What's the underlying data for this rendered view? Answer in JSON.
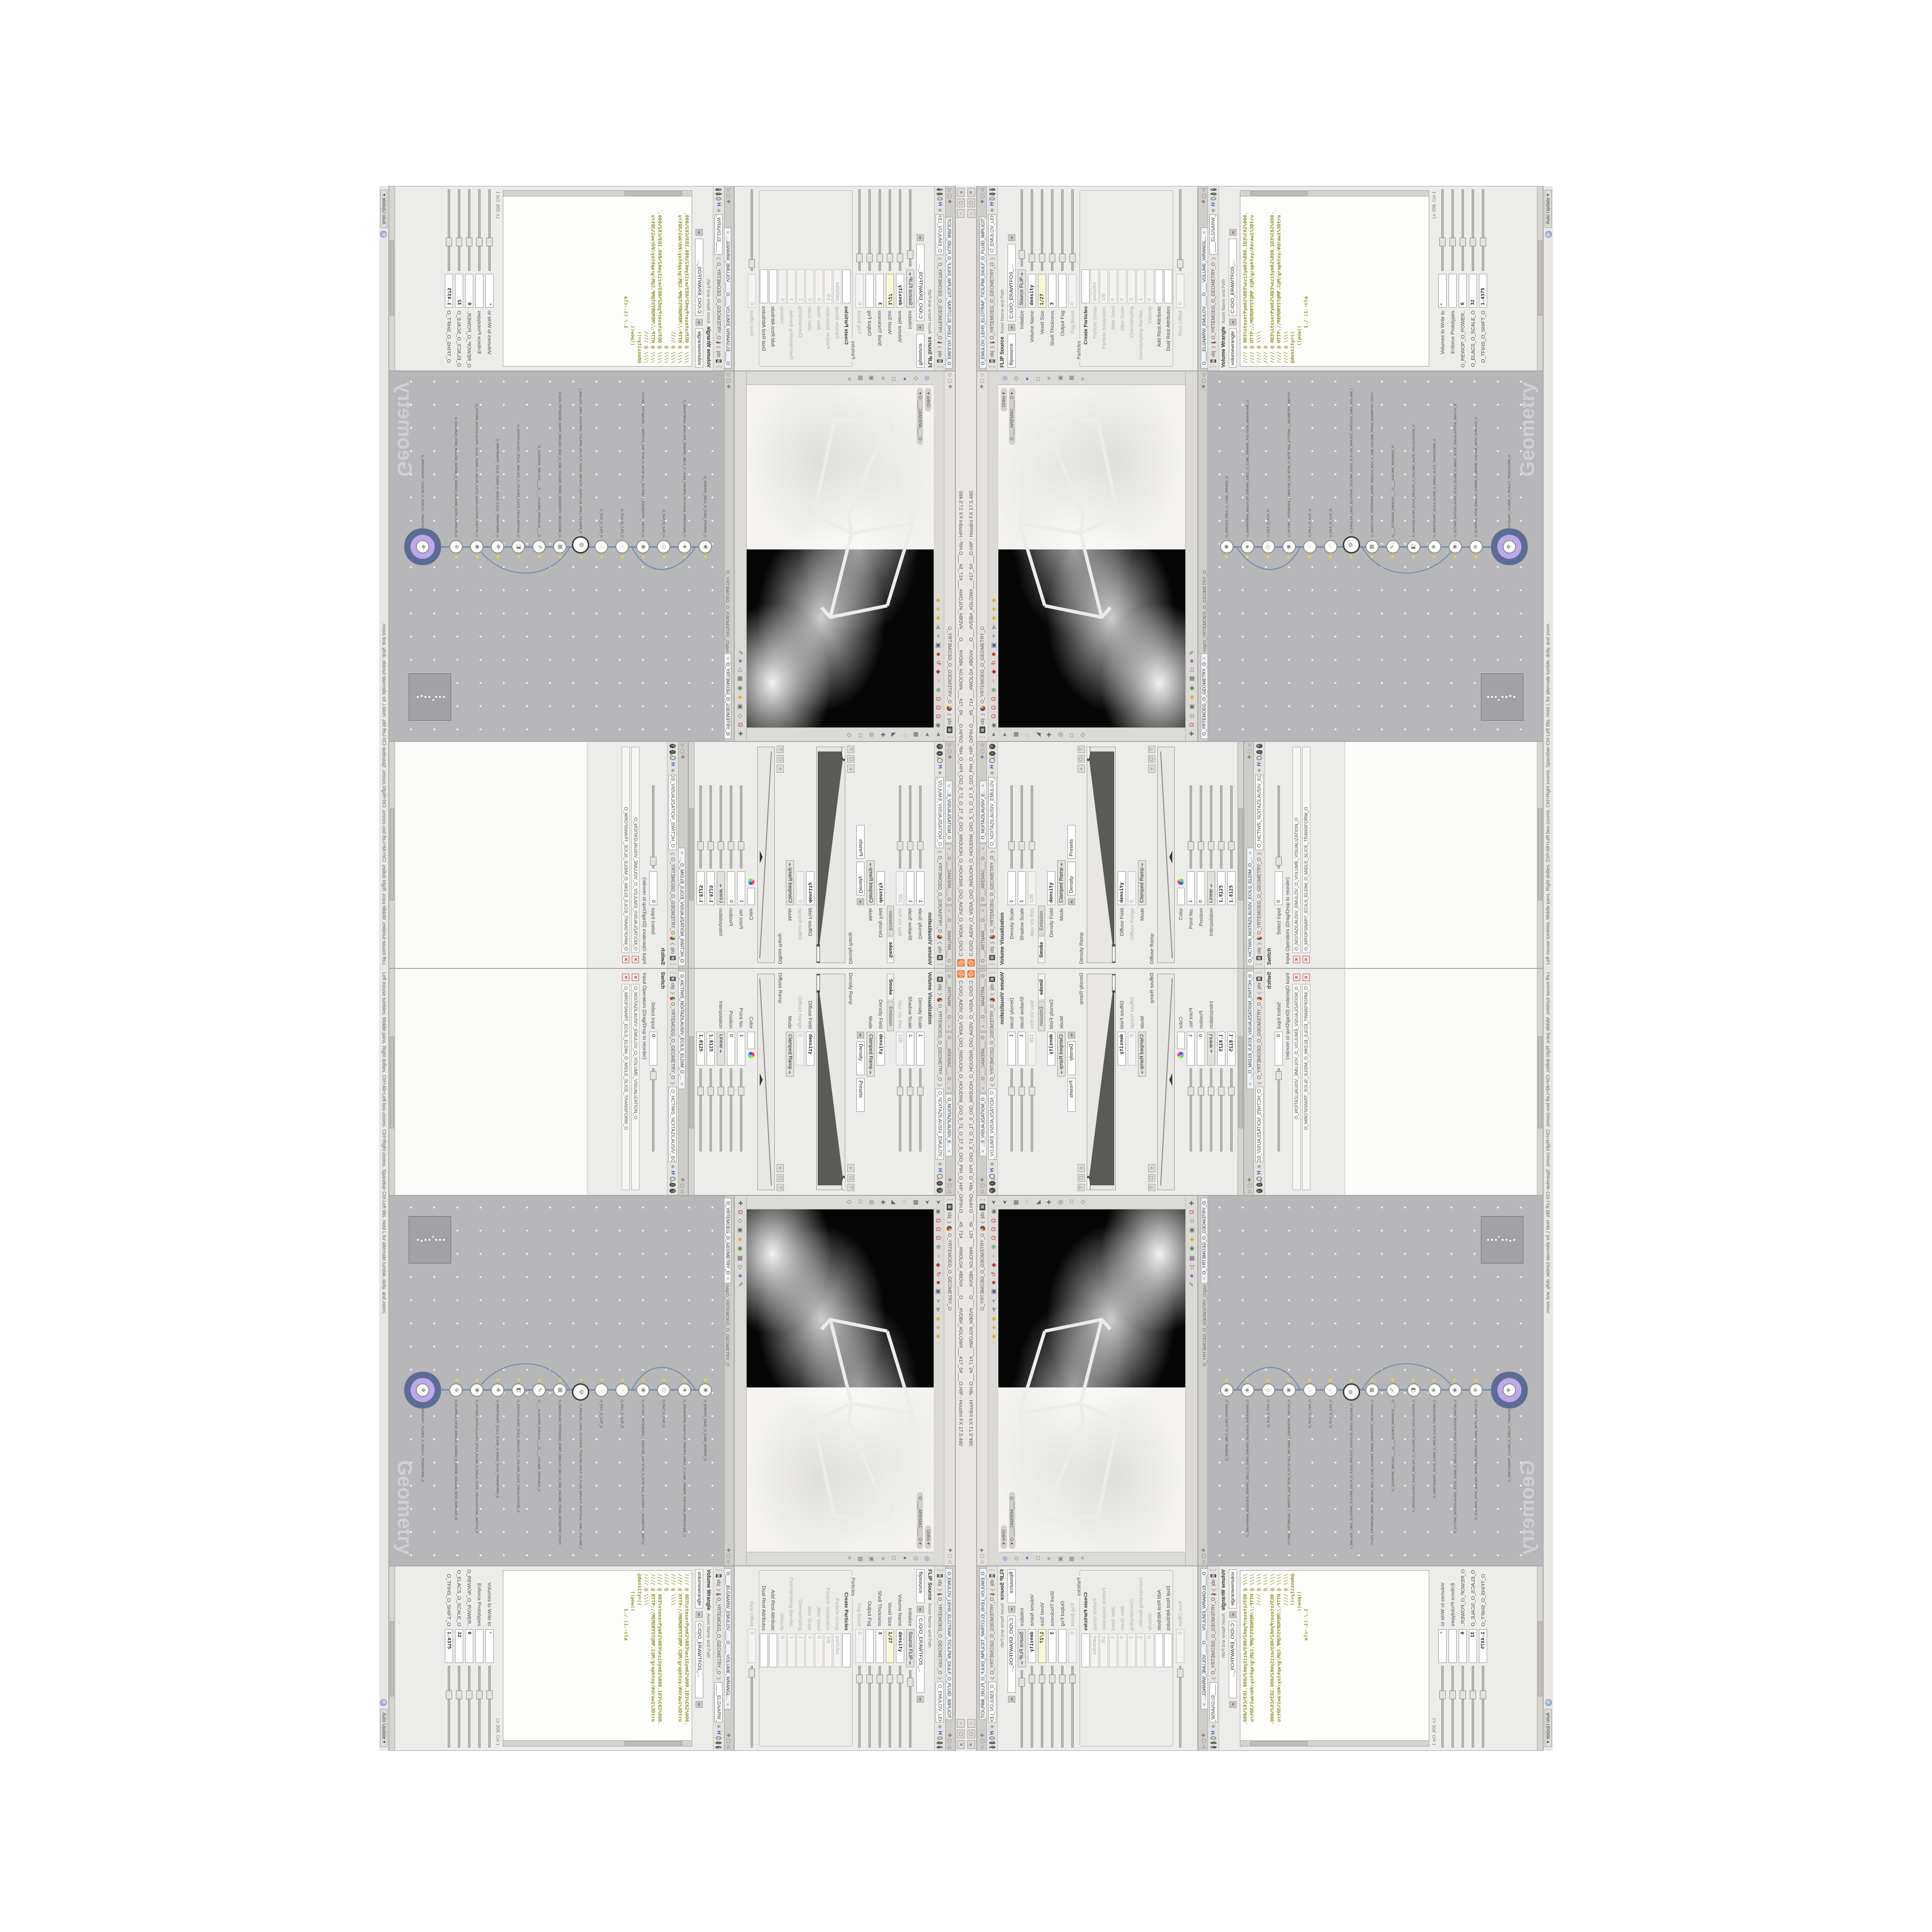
{
  "window": {
    "title": "C:/O/O_AIDIV_O_VIDIA_O/O_INIDUOH_O_HOUDINI_O/O_5_71_O_17_5_O/O_PIH_O_HIP_O/PIH.O___#5_71#___#WOLG#_#BDV#___O___#VDB#_#GLOW#___#17_5#___O.HIP - Houdini FX 17.5.460",
    "minimize": "–",
    "restore": "▢",
    "close": "✕"
  },
  "statusbar": {
    "help": "Left mouse tumbles. Middle pans. Right dollies. Ctrl+Alt+Left box-zooms. Ctrl+Right zooms. Spacebar-Ctrl-Left tilts. Hold L for alternate tumble, dolly, and zoom.",
    "auto_update": "Auto Update"
  },
  "breadcrumb": {
    "root": "obj",
    "geo": "O_YRTEMOEG_O_GEOMETRY_O"
  },
  "left_group": {
    "tabs": [
      {
        "label": "O ___ARTNAM___ O...",
        "cls": ""
      },
      {
        "label": "O ___AREMAC___ O...",
        "cls": ""
      },
      {
        "label": "O_NOITAZILAUSIV_E...",
        "cls": "active"
      }
    ]
  },
  "volviz": {
    "title": "Volume Visualization",
    "node_field": "O_NOITAZILAUSIV_EMULOV_O_VO",
    "rows_a": [
      {
        "label": "Density Scale",
        "value": "1",
        "cls": "slider"
      },
      {
        "label": "Shadow Scale",
        "value": "1",
        "cls": "slider"
      },
      {
        "label": "Max Vis Res",
        "value": "128",
        "cls": "gray"
      }
    ],
    "tab_smoke": "Smoke",
    "tab_emission": "Emission",
    "rows_b": [
      {
        "label": "Density Field",
        "value": "density",
        "cls": "bold"
      },
      {
        "label": "Mode",
        "value": "Clamped Ramp",
        "cls": "menu"
      }
    ],
    "mode_target": "Density",
    "presets": "Presets",
    "density_ramp_label": "Density Ramp",
    "rows_c": [
      {
        "label": "Diffuse Field",
        "value": "density",
        "cls": "bold"
      },
      {
        "label": "Diffuse Range",
        "value": "0",
        "cls": "gray slider"
      },
      {
        "label": "Mode",
        "value": "Clamped Ramp",
        "cls": "menu"
      }
    ],
    "mode2_target": "Diffuse",
    "diffuse_ramp_label": "Diffuse Ramp",
    "rows_d": [
      {
        "label": "Point No.",
        "value": "1",
        "cls": ""
      },
      {
        "label": "Position",
        "value": "0",
        "cls": "slider"
      },
      {
        "label": "Interpolation",
        "value": "Linear",
        "cls": "menu"
      },
      {
        "label": "",
        "value": "1.8125",
        "cls": "slider bold"
      },
      {
        "label": "",
        "value": "1.8125",
        "cls": "slider bold"
      },
      {
        "label": "",
        "value": "1.8125",
        "cls": "slider bold"
      }
    ],
    "color_label": "Color"
  },
  "switchp": {
    "tab": "O_HCTIWS_NOITAZILAUSIV_ECILS_ELDIM_O_...",
    "title": "Switch",
    "node_field": "O_HCTIWS_NOITAZILAUSIV_ECILS_ELDIM_O_",
    "rows": [
      {
        "label": "Select Input",
        "value": "0",
        "cls": "slider"
      }
    ],
    "group": "Input Operators (Drag/Drop to reorder)",
    "ops": [
      {
        "name": "O_NOITAZILAUSIV_EMULOV_O_VOLUME_VISUALIZATION_O"
      },
      {
        "name": "O_MROFSNART_ECILS_ELDIM_O_MIDLE_SLICE_TRANSFORM_O"
      }
    ]
  },
  "viewport": {
    "pills": [
      {
        "label": "Ortho ▾"
      },
      {
        "label": "O ___AREMAC___ O ▾"
      }
    ],
    "top_icons": [
      {
        "name": "select-arrow",
        "glyph": "➤",
        "color": "#666"
      },
      {
        "name": "handle",
        "glyph": "◉",
        "color": "#666"
      },
      {
        "name": "snap-magnet-1",
        "glyph": "Ω",
        "color": "#b5372c"
      },
      {
        "name": "snap-magnet-2",
        "glyph": "Ω",
        "color": "#b5372c"
      },
      {
        "name": "snap-magnet-3",
        "glyph": "Ω",
        "color": "#b5372c"
      },
      {
        "name": "axis-gnomon",
        "glyph": "⊕",
        "color": "#4a8f3c"
      },
      {
        "name": "cut-tool",
        "glyph": "✕",
        "color": "#caa"
      },
      {
        "name": "translate-tool",
        "glyph": "◆",
        "color": "#b5372c"
      },
      {
        "name": "rotate-tool",
        "glyph": "↻",
        "color": "#b5372c"
      },
      {
        "name": "scale-tool",
        "glyph": "■",
        "color": "#b5372c"
      },
      {
        "name": "view-3d",
        "glyph": "▣",
        "color": "#557"
      },
      {
        "name": "pointer",
        "glyph": "➤",
        "color": "#999"
      },
      {
        "name": "play",
        "glyph": "▶",
        "color": "#999"
      },
      {
        "name": "shade-box-1",
        "glyph": "◆",
        "color": "#d9b43a"
      },
      {
        "name": "shade-box-2",
        "glyph": "◈",
        "color": "#d9b43a"
      },
      {
        "name": "shade-box-3",
        "glyph": "◆",
        "color": "#d9b43a"
      }
    ],
    "left_icons": [
      {
        "name": "select-mode",
        "glyph": "➤",
        "color": "#666"
      },
      {
        "name": "box-pick",
        "glyph": "▦",
        "color": "#666"
      },
      {
        "name": "lasso-pick",
        "glyph": "◌",
        "color": "#666"
      },
      {
        "name": "brush",
        "glyph": "◢",
        "color": "#666"
      },
      {
        "name": "pan-hand",
        "glyph": "✚",
        "color": "#666"
      },
      {
        "name": "dolly-zoom",
        "glyph": "◎",
        "color": "#666"
      },
      {
        "name": "frame-all",
        "glyph": "□",
        "color": "#666"
      },
      {
        "name": "key-tool",
        "glyph": "◇",
        "color": "#666"
      }
    ],
    "right_icons": [
      {
        "name": "ripple-display",
        "glyph": "◎",
        "color": "#4a72c4"
      },
      {
        "name": "wire-cube",
        "glyph": "◇",
        "color": "#666"
      },
      {
        "name": "shaded-sphere",
        "glyph": "●",
        "color": "#5577cc"
      },
      {
        "name": "flat-square",
        "glyph": "□",
        "color": "#666"
      },
      {
        "name": "light-toggle",
        "glyph": "✳",
        "color": "#888"
      },
      {
        "name": "camera-toggle",
        "glyph": "▣",
        "color": "#888"
      },
      {
        "name": "grid-toggle",
        "glyph": "▦",
        "color": "#888"
      },
      {
        "name": "info-display",
        "glyph": "≡",
        "color": "#888"
      }
    ],
    "bottom_icons": [
      {
        "name": "persp-hand",
        "glyph": "✚",
        "color": "#666"
      },
      {
        "name": "view-magnet",
        "glyph": "Ω",
        "color": "#b5372c"
      },
      {
        "name": "view-key",
        "glyph": "◇",
        "color": "#666"
      },
      {
        "name": "snapshot",
        "glyph": "▣",
        "color": "#666"
      },
      {
        "name": "color-correct",
        "glyph": "◆",
        "color": "#d9b43a"
      },
      {
        "name": "exposure",
        "glyph": "◉",
        "color": "#4a8f3c"
      },
      {
        "name": "lut",
        "glyph": "▦",
        "color": "#666"
      },
      {
        "name": "res-fraction",
        "glyph": "▷",
        "color": "#666"
      },
      {
        "name": "sim-cache",
        "glyph": "■",
        "color": "#87b"
      },
      {
        "name": "grease-pencil",
        "glyph": "✎",
        "color": "#666"
      }
    ]
  },
  "network": {
    "tab": "O_YRTEMOEG_O_GEOMETRY_O",
    "path": "/obj/O_YRTEMOEG_O_GEOMETRY_O",
    "watermark": "Geometry",
    "nodes": [
      {
        "glyph": "◉",
        "name": "O_EREHPS_EBUC_O_CUBE_SPHERE_O",
        "cls": ""
      },
      {
        "glyph": "◈",
        "name": "O_EMARFERIW_NOGYLOP_EREHPS_EBUC_O_CUBE_SPHERE_POLYGON_WIREFRAME_O",
        "cls": ""
      },
      {
        "glyph": "◇",
        "name": "O_PILF_O_FLIP_O",
        "cls": ""
      },
      {
        "glyph": "◉",
        "name": "O_HCTIWS_YRTEMOEG_LANRETXE_LANRETNI_O_INTERNAL_EXTERNAL_GEOMETRY_SWITCH_O",
        "cls": ""
      },
      {
        "glyph": "◌",
        "name": "O_PILC_O_CLIP_O",
        "cls": ""
      },
      {
        "glyph": "◌",
        "name": "O_PILC_O_CLIP_O",
        "cls": ""
      },
      {
        "glyph": "◍",
        "name": "O_EMULOV_LEHS_ELCITRAP_TICILPMI_DIULF_O_FLUID_IMPLICIT_PARTICLE_SHEL_VOLUME_O",
        "cls": "big"
      },
      {
        "glyph": "▦",
        "name": "O_SNOGYLOP_YRTEMOEG_MORF_EMULOV_BDV_O_VDB_VOLUME_FROM_GEOMETRY_POLYGONS_O",
        "cls": ""
      },
      {
        "glyph": "✎",
        "name": "O____ELGNARW_EMULOV____O____VOLUME_WRANGLE_O",
        "cls": ""
      },
      {
        "glyph": "◧",
        "name": "O_NOITAZILAUSIV_ECILS_EMULOV_O_VOLUME_SLICE_VISUALIZATION_O",
        "cls": ""
      },
      {
        "glyph": "✥",
        "name": "O_MROFSNART_ECILS_ELDIM_O_MIDLE_SLICE_TRANSFORM_O",
        "cls": ""
      },
      {
        "glyph": "◉",
        "name": "O_HCTIWS_NOITAZILAUSIV_ECILS_ELDIM_O_MIDLE_SLICE_VISUALIZATION_SWITCH_O",
        "cls": ""
      },
      {
        "glyph": "⊕",
        "name": "O_ECAFRUS_HTIW_EMULOV_EGREM_O_MERGE_VOLUME_WITH_SURFACE_O",
        "cls": ""
      },
      {
        "glyph": "✥",
        "name": "O_MROFSNART_TLUSER_O_RESULT_TRANSFORM_O",
        "cls": "selected"
      }
    ]
  },
  "flip": {
    "tab": "O_EMULOV_LEHS_ELCITRAP_TICILPMI_DIULF_O_FLUID_IMPLICIT_PARTICLE...",
    "title": "FLIP Source",
    "node_field": "O_EMULOV_LEHS_ELCITRAP_TICILPMI_DI",
    "asset_label": "Asset Name and Path",
    "asset_name": "flipsource",
    "asset_path": "C:/O/O_ERAWTFOS_...",
    "rows_a": [
      {
        "label": "Initialize",
        "value": "Source FLIP",
        "cls": "menu"
      },
      {
        "label": "Volume Name",
        "value": "density",
        "cls": "bold"
      },
      {
        "label": "Voxel Size",
        "value": "1/27",
        "cls": "yellow slider bold"
      },
      {
        "label": "Shell Thickness",
        "value": "3",
        "cls": "slider bold"
      },
      {
        "label": "Output Fog",
        "value": "",
        "cls": "chk"
      },
      {
        "label": "Fog Boost",
        "value": "0",
        "cls": "gray slider"
      }
    ],
    "particles_label": "Particles",
    "rows_b": [
      {
        "label": "Create Particles",
        "value": "",
        "cls": "chk bolded"
      },
      {
        "label": "Particle Group",
        "value": "particles",
        "cls": "gray"
      },
      {
        "label": "Particle Separation",
        "value": "1/9",
        "cls": "gray slider"
      },
      {
        "label": "Jitter Seed",
        "value": "0",
        "cls": "gray"
      },
      {
        "label": "Jitter Scale",
        "value": "0",
        "cls": "gray slider"
      },
      {
        "label": "Oversampling",
        "value": "2",
        "cls": "gray slider"
      },
      {
        "label": "Oversampling Bandwi...",
        "value": "1",
        "cls": "gray"
      },
      {
        "label": "Velocity",
        "value": "0",
        "cls": "gray"
      },
      {
        "label": "Add Rest Attribute",
        "value": "",
        "cls": "chk"
      },
      {
        "label": "Dual Rest Attributes",
        "value": "",
        "cls": "chk"
      }
    ],
    "rows_c": [
      {
        "label": "Rest Offset",
        "value": "0",
        "cls": "gray slider"
      }
    ]
  },
  "wrangle": {
    "tab": "O____ELGNARW_EMULOV____O____VOLUME_WRANGL...",
    "title": "Volume Wrangle",
    "node_field": "____ELGNARW_EMULOV____O____VOl",
    "asset_label": "Asset Name and Path",
    "asset_name": "volumewrangle",
    "asset_path": "C:/O/O_ERAWTFOS_...",
    "code_lines": [
      {
        "t": "//// @ 0D3%steserPym62%0D3%eziSym62%000.1D3%C62%000.",
        "c": ""
      },
      {
        "t": "//// @ HTTP://MEMORYST@MP.C@M/graphtoy/#draw1%3Dtru",
        "c": ""
      },
      {
        "t": "//// @ \\\\\\\\",
        "c": ""
      },
      {
        "t": "//// @",
        "c": ""
      },
      {
        "t": "//// @ 0D3%steserPym62%0D3%eziSym62%000.1D3%C62%000.",
        "c": ""
      },
      {
        "t": "//// @ HTTP://MEMORYST@MP.C@M/graphtoy/#draw1%3Dtru",
        "c": ""
      },
      {
        "t": "//// @ \\\\\\\\",
        "c": ""
      },
      {
        "t": "",
        "c": ""
      },
      {
        "t": "@density=((",
        "c": "dark"
      },
      {
        "t": "      ((pow((",
        "c": "dark"
      },
      {
        "t": "            1./ (1.-cla",
        "c": "teal"
      }
    ],
    "lncol": "Ln 209, Col 1",
    "rows": [
      {
        "label": "Volumes to Write to",
        "value": "*",
        "cls": ""
      },
      {
        "label": "Enforce Prototypes",
        "value": "",
        "cls": "chk"
      },
      {
        "label": "O_REWOP_O_POWER...",
        "value": "6",
        "cls": "slider bold"
      },
      {
        "label": "O_ELACS_O_SCALE_O",
        "value": "32",
        "cls": "slider bold"
      },
      {
        "label": "O_TFIHS_O_SHIFT_O",
        "value": "1.4375",
        "cls": "slider bold"
      }
    ]
  },
  "colors": {
    "accent_orange": "#f26b21",
    "field_yellow": "#fbf8d8",
    "code_olive": "#8f8f23",
    "code_teal": "#2a9d9d",
    "wire_blue": "#5b7fae",
    "node_select_purple": "#bda8ec",
    "node_select_ring": "#5d6c94",
    "network_bg": "#b7b6b9",
    "viewport_black": "#050505",
    "viewport_white": "#f4f3ef"
  }
}
